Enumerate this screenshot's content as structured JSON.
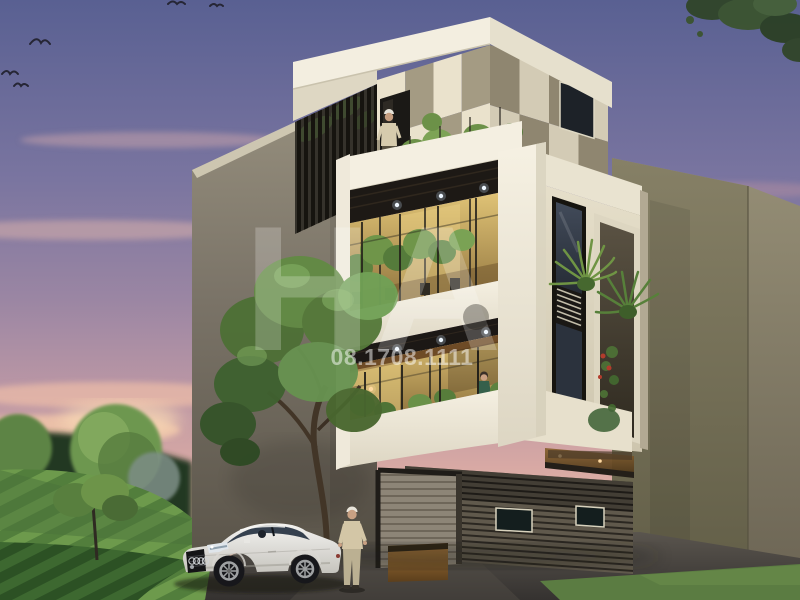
{
  "watermark": {
    "logo_text": "HA",
    "phone": "08.1708.1111",
    "text_color": "#ffffff"
  },
  "palette": {
    "sky_top": "#596092",
    "sky_horizon": "#f0cbb2",
    "facade_cream": "#eae2cc",
    "facade_taupe": "#a49b83",
    "balcony_white": "#f4efe1",
    "warm_glass": "#d9bc6d",
    "soffit_wood": "#2e2a23",
    "side_wall": "#7b7468",
    "slat_dark": "#2b2721",
    "foliage": "#628a44",
    "grass": "#6d9a4c",
    "road": "#46423c",
    "neighbor_olive": "#7d7664",
    "car_body": "#f2f1ee"
  }
}
